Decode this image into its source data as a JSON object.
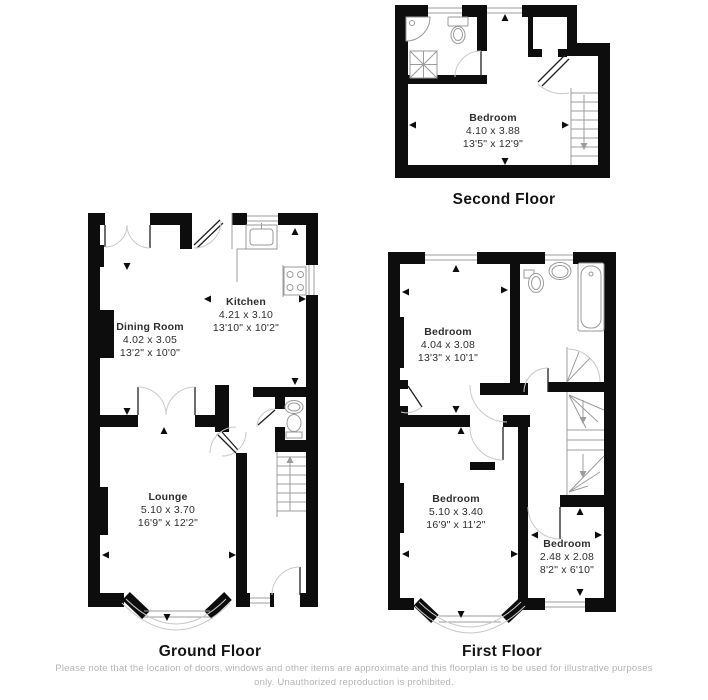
{
  "colors": {
    "wall": "#0d0d0d",
    "thin_line": "#9c9c9c",
    "door_arc": "#c9c9c9",
    "label_text": "#2e2e2e",
    "caption_text": "#141414",
    "disclaimer_text": "#b4b4b4",
    "background": "#ffffff"
  },
  "floors": {
    "second": {
      "caption": "Second Floor",
      "rooms": {
        "bedroom": {
          "name": "Bedroom",
          "metric": "4.10 x 3.88",
          "imperial": "13'5\" x 12'9\""
        }
      }
    },
    "ground": {
      "caption": "Ground Floor",
      "rooms": {
        "dining": {
          "name": "Dining Room",
          "metric": "4.02 x 3.05",
          "imperial": "13'2\" x 10'0\""
        },
        "kitchen": {
          "name": "Kitchen",
          "metric": "4.21 x 3.10",
          "imperial": "13'10\" x 10'2\""
        },
        "lounge": {
          "name": "Lounge",
          "metric": "5.10 x 3.70",
          "imperial": "16'9\" x 12'2\""
        }
      }
    },
    "first": {
      "caption": "First Floor",
      "rooms": {
        "bedroom1": {
          "name": "Bedroom",
          "metric": "4.04 x 3.08",
          "imperial": "13'3\" x 10'1\""
        },
        "bedroom2": {
          "name": "Bedroom",
          "metric": "5.10 x 3.40",
          "imperial": "16'9\" x 11'2\""
        },
        "bedroom3": {
          "name": "Bedroom",
          "metric": "2.48 x 2.08",
          "imperial": "8'2\" x 6'10\""
        }
      }
    }
  },
  "disclaimer": "Please note that the location of doors, windows and other items are approximate and this floorplan is to be used for illustrative purposes only. Unauthorized reproduction is prohibited."
}
